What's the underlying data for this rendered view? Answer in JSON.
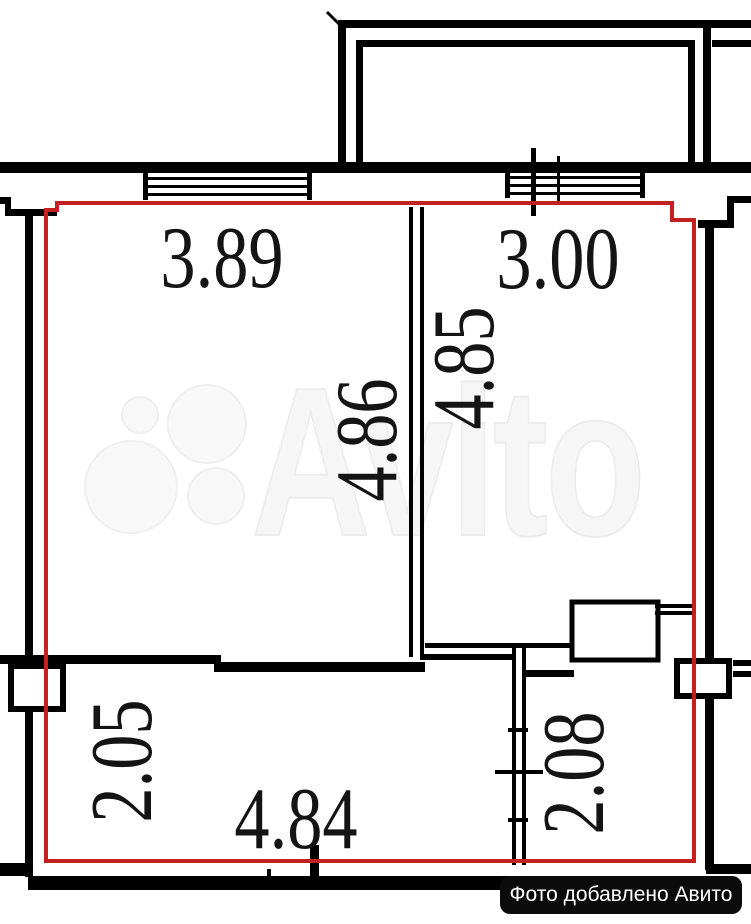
{
  "watermark": {
    "text": "Avito"
  },
  "badge": {
    "text": "Фото добавлено Авито"
  },
  "dimensions": {
    "room_left_width": "3.89",
    "room_right_width": "3.00",
    "room_left_depth": "4.86",
    "room_right_depth": "4.85",
    "hall_depth": "2.05",
    "hall_width": "4.84",
    "bath_depth": "2.08"
  },
  "colors": {
    "apartment_outline": "#c32020",
    "walls": "#000000",
    "badge_bg": "#0b0b0b",
    "badge_text": "#ffffff",
    "watermark": "#f6f6f6"
  }
}
